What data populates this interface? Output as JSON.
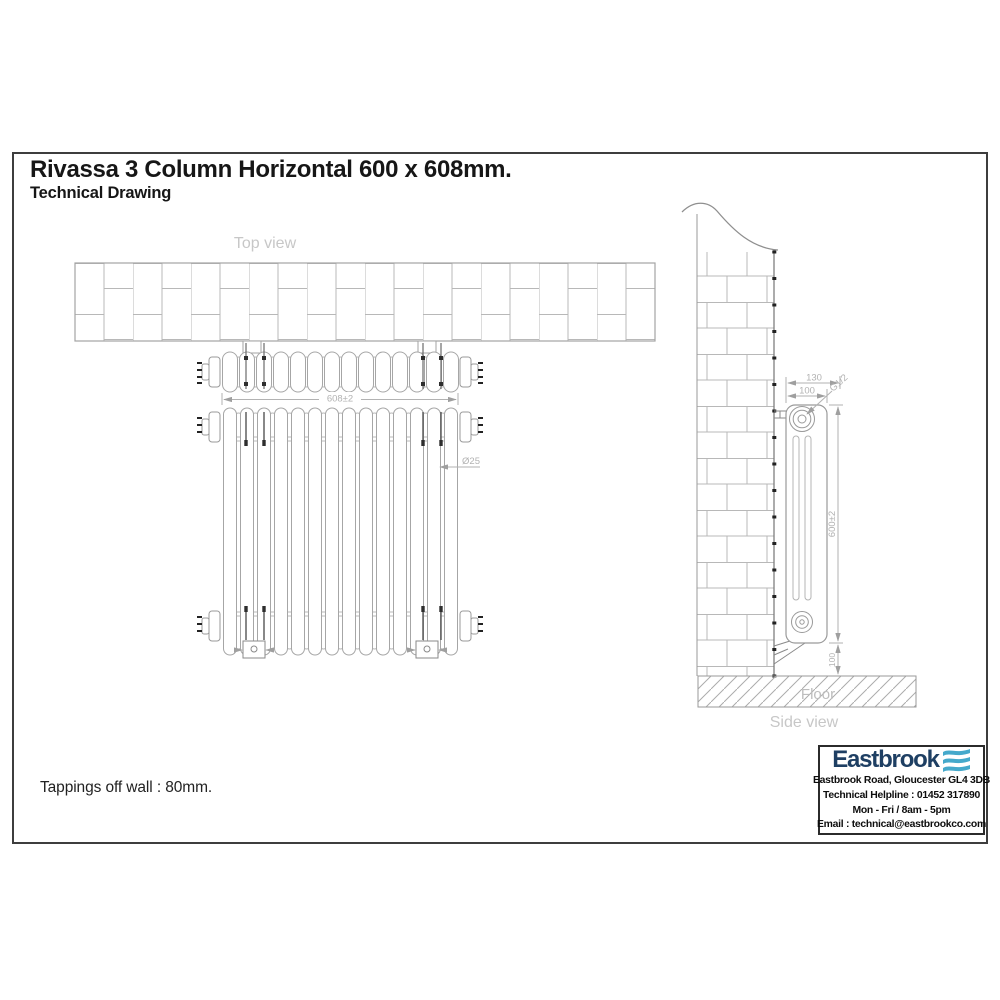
{
  "page": {
    "title": "Rivassa 3 Column Horizontal 600 x 608mm.",
    "subtitle": "Technical Drawing",
    "note": "Tappings off wall : 80mm."
  },
  "drawing": {
    "top_view_label": "Top view",
    "side_view_label": "Side view",
    "floor_label": "Floor",
    "section_count": 14,
    "dims": {
      "overall_width": "608±2",
      "column_diameter": "Ø25",
      "bracket_projection": "130",
      "radiator_depth": "100",
      "tapping_thread": "G1/2",
      "overall_height": "600±2",
      "floor_clearance": "100"
    },
    "line_color": "#a6a6a6",
    "light_line_color": "#b9b9b9",
    "label_color": "#c7c7c7"
  },
  "brand": {
    "name": "Eastbrook",
    "address": "Eastbrook Road, Gloucester GL4 3DB",
    "helpline": "Technical Helpline : 01452 317890",
    "hours": "Mon - Fri / 8am - 5pm",
    "email": "Email : technical@eastbrookco.com",
    "navy": "#1e3f63",
    "teal": "#45a9cb"
  }
}
